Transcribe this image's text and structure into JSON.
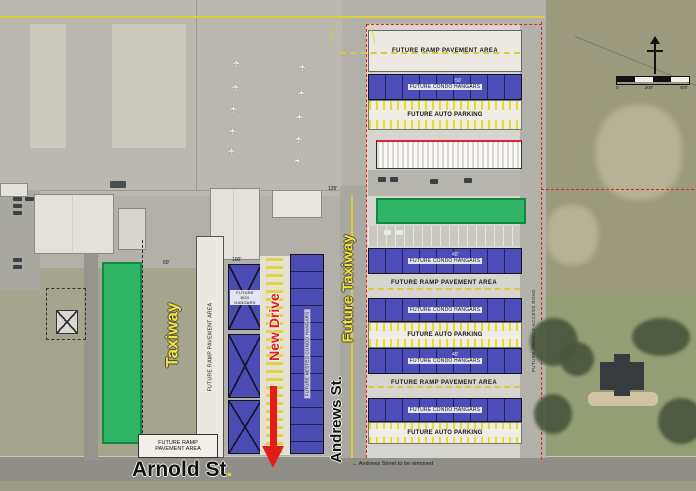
{
  "annotations": {
    "taxiway": "Taxiway",
    "future_taxiway": "Future Taxiway",
    "new_drive": "New Drive",
    "arnold_st": "Arnold St",
    "arnold_period": ".",
    "andrews_st": "Andrews St.",
    "access_road": "FUTURE VEHICLE ACCESS ROAD",
    "andrews_note": "Andrews Street to be removed",
    "note_arrow": "←"
  },
  "area_labels": {
    "ramp": "FUTURE RAMP PAVEMENT AREA",
    "condo": "FUTURE CONDO HANGARS",
    "auto_parking": "FUTURE AUTO PARKING",
    "box_hangars": "FUTURE BOX HANGARS",
    "nested_condo": "FUTURE NESTED CONDO HANGARS",
    "ramp_line1": "FUTURE RAMP",
    "ramp_line2": "PAVEMENT AREA"
  },
  "dimensions": {
    "d125": "125'",
    "d100": "100'",
    "d60": "60'",
    "d50": "50'",
    "d45": "45'",
    "d40": "40'"
  },
  "scale_bar": {
    "labels": [
      "0",
      "200'",
      "400'"
    ]
  },
  "colors": {
    "highlight_green": "#2fb565",
    "hangar_blue": "#3a3ab6",
    "taxiway_yellow": "#f2e43c",
    "drive_red": "#e31e18",
    "boundary_red": "#e02218"
  }
}
